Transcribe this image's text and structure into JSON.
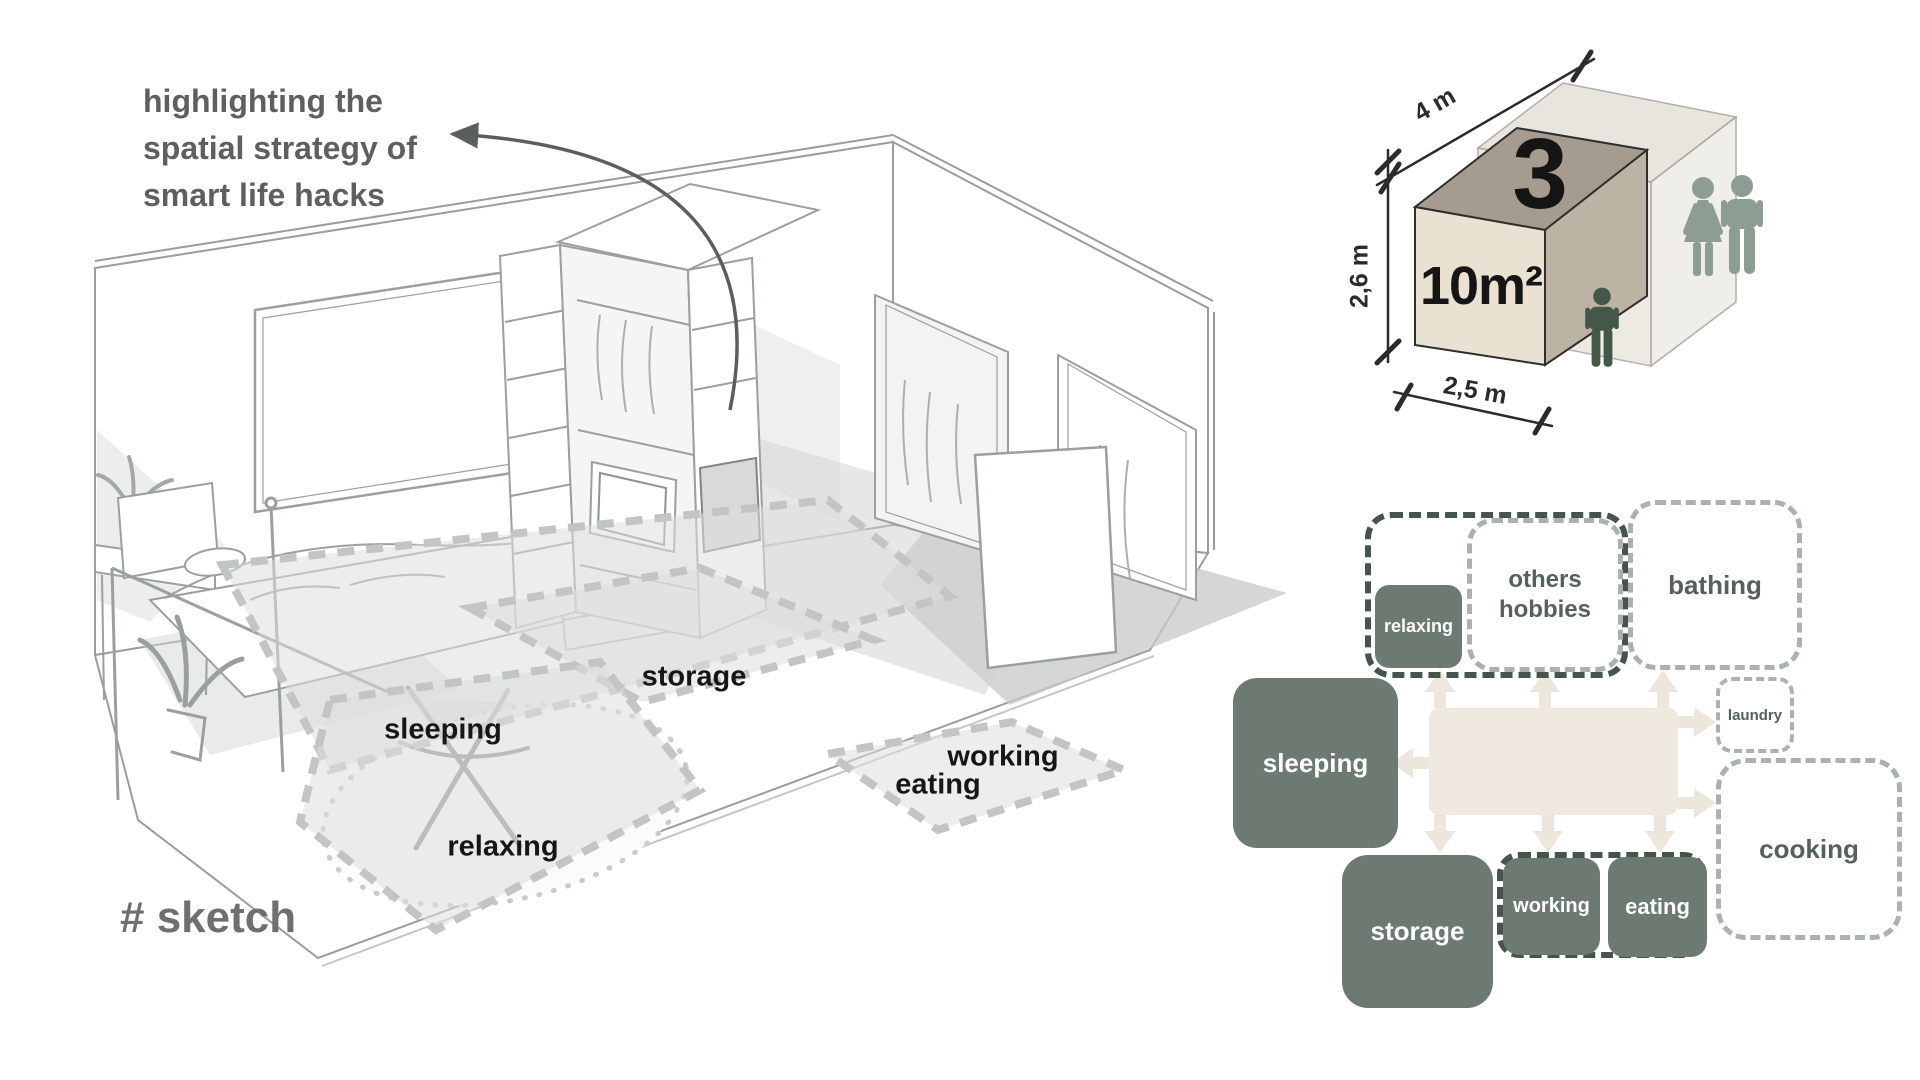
{
  "palette": {
    "solid_box": "#6d7a72",
    "dashed_light": "#a9b2ac",
    "dashed_dark": "#46554c",
    "hub_beige": "#eee8df",
    "label_dark": "#546259",
    "sketch_ink": "#161616",
    "annotation_gray": "#5c605e",
    "hash_gray": "#6f6f6f",
    "person_couple": "#8e9d92",
    "person_single": "#44584a"
  },
  "annotation": {
    "line1": "highlighting the",
    "line2": "spatial strategy of",
    "line3": "smart life hacks"
  },
  "sketch_tag": "# sketch",
  "sketch_zones": {
    "sleeping": "sleeping",
    "storage": "storage",
    "relaxing": "relaxing",
    "working": "working",
    "eating": "eating"
  },
  "cube": {
    "count": "3",
    "area": "10m²",
    "width": "4 m",
    "height": "2,6 m",
    "depth": "2,5 m"
  },
  "diagram": {
    "relaxing": "relaxing",
    "others_hobbies": "others hobbies",
    "bathing": "bathing",
    "laundry": "laundry",
    "sleeping": "sleeping",
    "cooking": "cooking",
    "storage": "storage",
    "working": "working",
    "eating": "eating"
  }
}
